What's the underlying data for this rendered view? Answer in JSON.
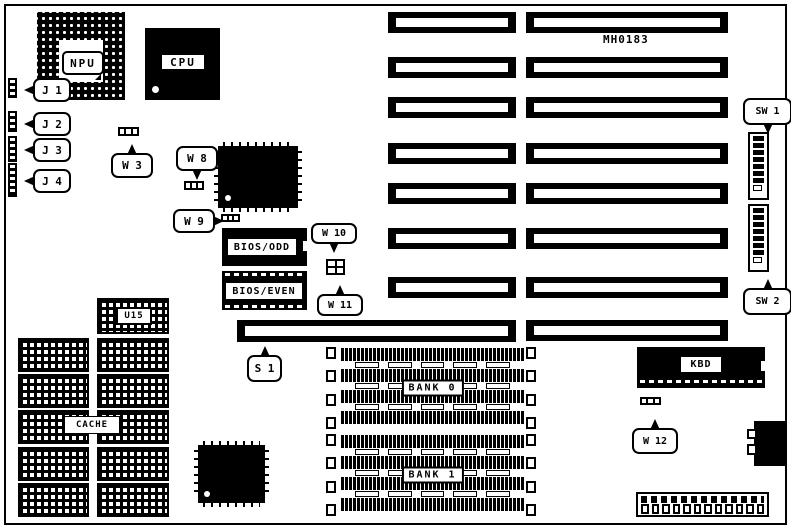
{
  "diagram": {
    "board_code": "MH0183",
    "colors": {
      "ink": "#000000",
      "paper": "#ffffff"
    },
    "chips": {
      "npu": "NPU",
      "cpu": "CPU",
      "bios_odd": "BIOS/ODD",
      "bios_even": "BIOS/EVEN",
      "u15": "U15",
      "cache": "CACHE",
      "bank0": "BANK 0",
      "bank1": "BANK 1",
      "kbd": "KBD"
    },
    "callouts": {
      "j1": "J 1",
      "j2": "J 2",
      "j3": "J 3",
      "j4": "J 4",
      "w3": "W 3",
      "w8": "W 8",
      "w9": "W 9",
      "w10": "W 10",
      "w11": "W 11",
      "w12": "W 12",
      "s1": "S 1",
      "sw1": "SW 1",
      "sw2": "SW 2"
    }
  }
}
